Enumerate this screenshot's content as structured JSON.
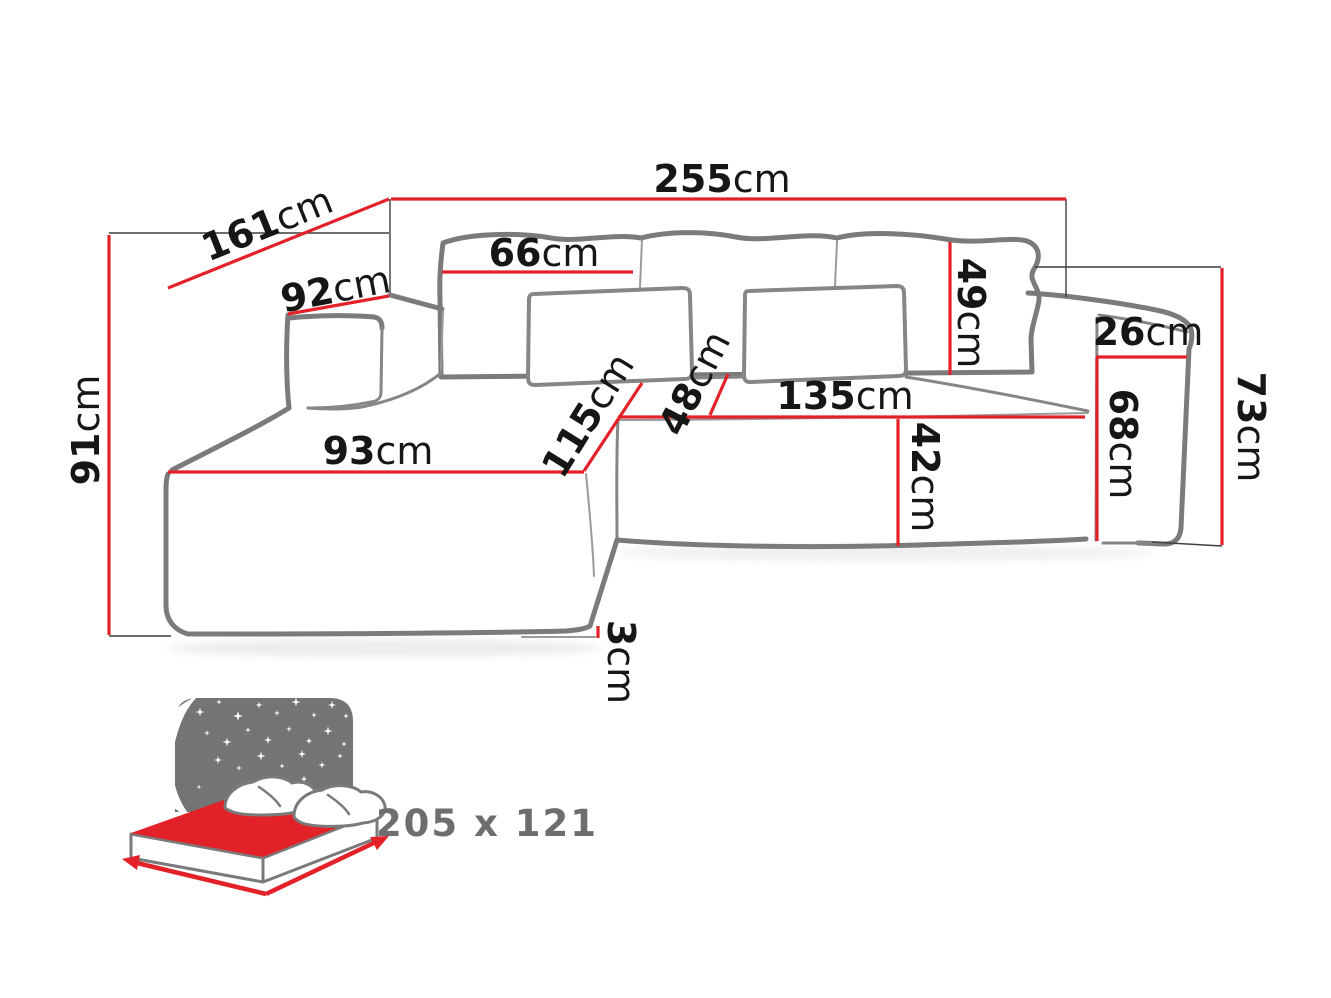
{
  "diagram_title": "corner sofa dimension drawing",
  "colors": {
    "dimension_line_red": "#e32128",
    "sofa_outline_gray": "#7b7b7b",
    "guide_line_dark": "#3f3f3f",
    "label_text": "#161616",
    "bed_icon_gray": "#747474",
    "bed_mattress_red": "#e32128",
    "bed_size_text": "#6e6e6e"
  },
  "icons": {
    "bed": "sleeping-function-bed-icon"
  },
  "dims": {
    "d255": {
      "value": "255",
      "unit": "cm"
    },
    "d161": {
      "value": "161",
      "unit": "cm"
    },
    "d92": {
      "value": "92",
      "unit": "cm"
    },
    "d91": {
      "value": "91",
      "unit": "cm"
    },
    "d66": {
      "value": "66",
      "unit": "cm"
    },
    "d49": {
      "value": "49",
      "unit": "cm"
    },
    "d26": {
      "value": "26",
      "unit": "cm"
    },
    "d73": {
      "value": "73",
      "unit": "cm"
    },
    "d68": {
      "value": "68",
      "unit": "cm"
    },
    "d115": {
      "value": "115",
      "unit": "cm"
    },
    "d48": {
      "value": "48",
      "unit": "cm"
    },
    "d135": {
      "value": "135",
      "unit": "cm"
    },
    "d42": {
      "value": "42",
      "unit": "cm"
    },
    "d93": {
      "value": "93",
      "unit": "cm"
    },
    "d3": {
      "value": "3",
      "unit": "cm"
    }
  },
  "sleeping_area": {
    "size": "205 x 121"
  }
}
